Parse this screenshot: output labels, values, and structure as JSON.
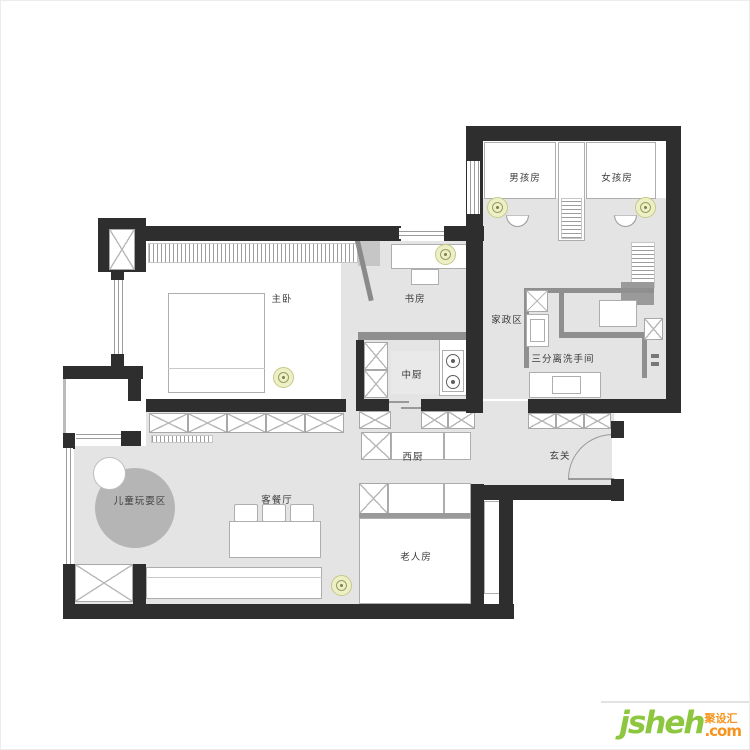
{
  "plan": {
    "title": "apartment-floor-plan",
    "rooms": [
      {
        "id": "master-bedroom",
        "label": "主卧"
      },
      {
        "id": "study",
        "label": "书房"
      },
      {
        "id": "boys-room",
        "label": "男孩房"
      },
      {
        "id": "girls-room",
        "label": "女孩房"
      },
      {
        "id": "housekeeping-area",
        "label": "家政区"
      },
      {
        "id": "split-bathroom",
        "label": "三分离洗手间"
      },
      {
        "id": "chinese-kitchen",
        "label": "中厨"
      },
      {
        "id": "western-kitchen",
        "label": "西厨"
      },
      {
        "id": "entry-foyer",
        "label": "玄关"
      },
      {
        "id": "living-dining",
        "label": "客餐厅"
      },
      {
        "id": "kids-play-area",
        "label": "儿童玩耍区"
      },
      {
        "id": "elderly-room",
        "label": "老人房"
      }
    ],
    "colors": {
      "wall": "#2e2e2e",
      "floor": "#e4e4e4",
      "partition_wall": "#8f8f8f",
      "light_fixture": "#edf0c6",
      "play_circle": "#b5b5b5"
    }
  },
  "watermark": {
    "brand": "jsheh",
    "suffix": ".com",
    "brand_cn": "聚设汇",
    "green": "#8dc63f",
    "orange": "#f7941e"
  }
}
